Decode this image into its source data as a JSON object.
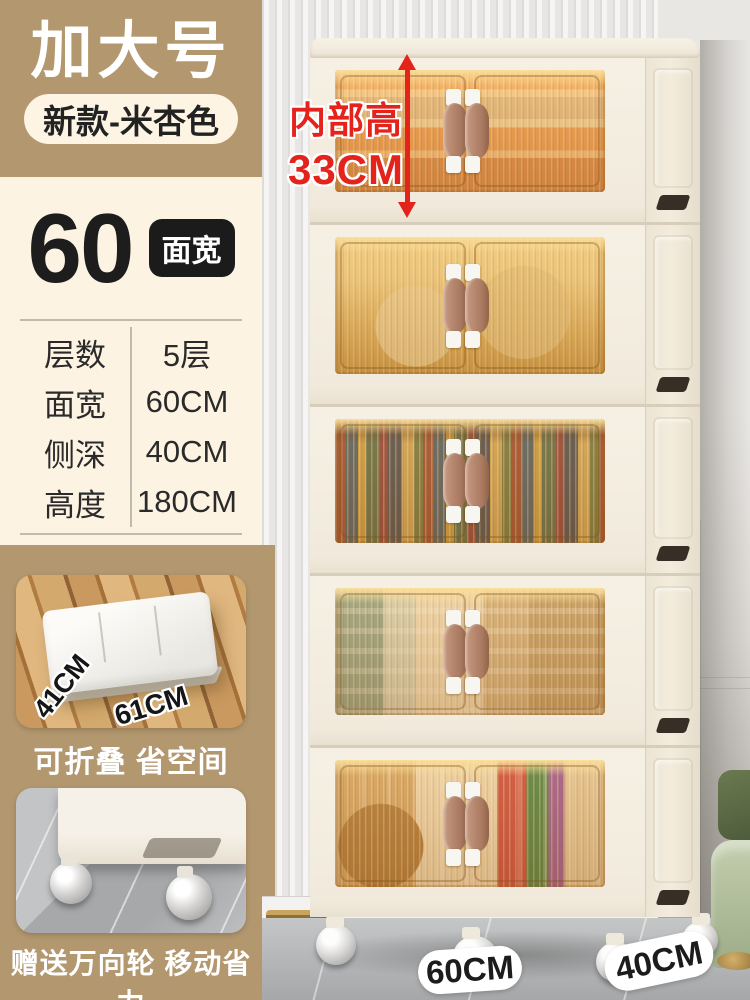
{
  "sidebar": {
    "badge_title": "加大号",
    "variant_pill": "新款-米杏色",
    "size_number": "60",
    "size_tag": "面宽",
    "specs": [
      {
        "label": "层数",
        "value": "5层"
      },
      {
        "label": "面宽",
        "value": "60CM"
      },
      {
        "label": "侧深",
        "value": "40CM"
      },
      {
        "label": "高度",
        "value": "180CM"
      }
    ],
    "fold_photo": {
      "depth_label": "41CM",
      "width_label": "61CM"
    },
    "caption_fold": "可折叠 省空间",
    "caption_wheels": "赠送万向轮 移动省力"
  },
  "main_photo": {
    "height_annotation": {
      "line1": "内部高",
      "line2": "33CM"
    },
    "width_label": "60CM",
    "depth_label": "40CM",
    "tier_count": 5
  },
  "colors": {
    "accent_tan": "#b2976f",
    "panel_cream": "#fcf3e2",
    "tag_black": "#1d1d1d",
    "annotation_red": "#e3231c",
    "cabinet_cream": "#f3ecdf"
  }
}
